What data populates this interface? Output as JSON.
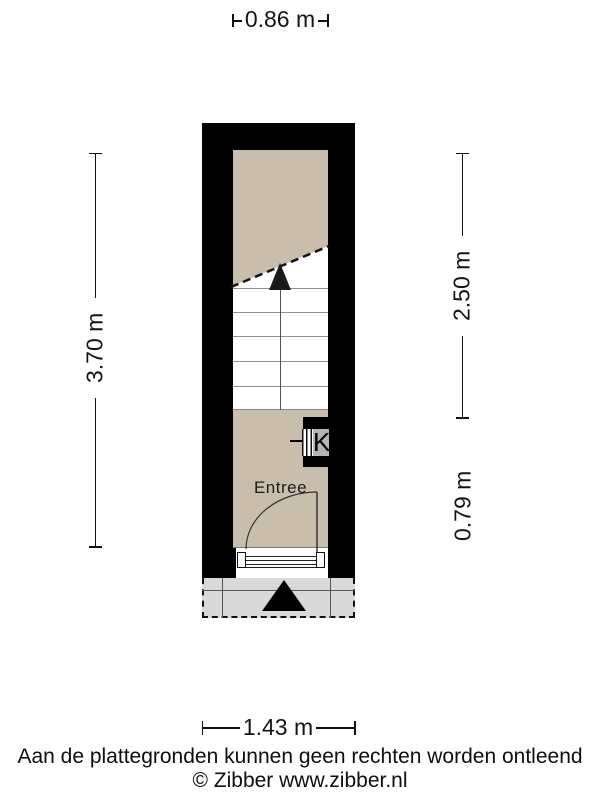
{
  "floorplan": {
    "room_label": "Entree",
    "meter_cupboard_label": "K"
  },
  "dimensions": {
    "top_width": "0.86 m",
    "left_height": "3.70 m",
    "right_upper_height": "2.50 m",
    "right_lower_height": "0.79 m",
    "bottom_width": "1.43 m"
  },
  "footer": {
    "disclaimer": "Aan de plattegronden kunnen geen rechten worden ontleend",
    "copyright": "© Zibber www.zibber.nl"
  },
  "colors": {
    "wall": "#000000",
    "floor": "#c9bdab",
    "porch": "#d9d9d9",
    "meter_box": "#b4b4b4"
  }
}
